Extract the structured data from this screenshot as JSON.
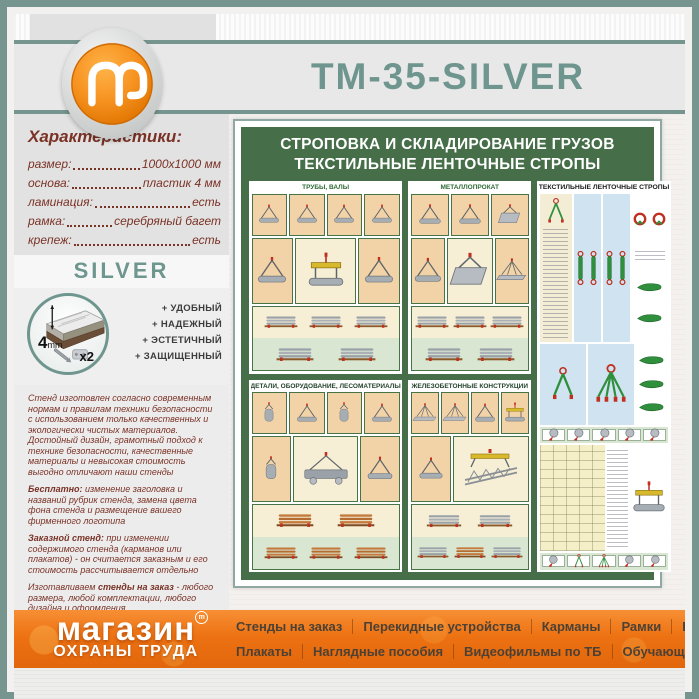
{
  "header": {
    "title": "ТМ-35-SILVER",
    "logo_letter": "m"
  },
  "sidebar": {
    "characteristics": {
      "heading": "Характеристики:",
      "rows": [
        {
          "label": "размер:",
          "value": "1000х1000 мм"
        },
        {
          "label": "основа:",
          "value": "пластик 4 мм"
        },
        {
          "label": "ламинация:",
          "value": "есть"
        },
        {
          "label": "рамка:",
          "value": "серебряный багет"
        },
        {
          "label": "крепеж:",
          "value": "есть"
        }
      ]
    },
    "frame_label": "SILVER",
    "frame_icon": {
      "thickness": "4",
      "unit": "mm",
      "screws": "x2"
    },
    "features": [
      "+ УДОБНЫЙ",
      "+ НАДЕЖНЫЙ",
      "+ ЭСТЕТИЧНЫЙ",
      "+ ЗАЩИЩЕННЫЙ"
    ],
    "paragraphs": [
      [
        {
          "bold": false,
          "text": "Стенд изготовлен согласно современным нормам и правилам техники безопасности с использованием только качественных и экологически чистых материалов. Достойный дизайн, грамотный подход к технике безопасности, качественные материалы и невысокая стоимость выгодно отличают наши стенды"
        }
      ],
      [
        {
          "bold": true,
          "text": "Бесплатно:"
        },
        {
          "bold": false,
          "text": " изменение заголовка и названий рубрик стенда, замена цвета фона стенда и размещение вашего фирменного логотипа"
        }
      ],
      [
        {
          "bold": true,
          "text": "Заказной стенд:"
        },
        {
          "bold": false,
          "text": " при изменении содержимого стенда (карманов или плакатов) - он считается заказным и его стоимость рассчитывается отдельно"
        }
      ],
      [
        {
          "bold": false,
          "text": "Изготавливаем "
        },
        {
          "bold": true,
          "text": "стенды на заказ"
        },
        {
          "bold": false,
          "text": " - любого размера, любой комплектации, любого дизайна и оформления"
        }
      ]
    ]
  },
  "poster": {
    "title_line1": "СТРОПОВКА И СКЛАДИРОВАНИЕ ГРУЗОВ",
    "title_line2": "ТЕКСТИЛЬНЫЕ ЛЕНТОЧНЫЕ СТРОПЫ",
    "panels": [
      "ТРУБЫ, ВАЛЫ",
      "МЕТАЛЛОПРОКАТ",
      "ТЕКСТИЛЬНЫЕ ЛЕНТОЧНЫЕ СТРОПЫ",
      "ДЕТАЛИ, ОБОРУДОВАНИЕ, ЛЕСОМАТЕРИАЛЫ",
      "ЖЕЛЕЗОБЕТОННЫЕ КОНСТРУКЦИИ"
    ]
  },
  "footer": {
    "logo_line1": "магазин",
    "logo_reg": "m",
    "logo_line2": "ОХРАНЫ ТРУДА",
    "menu_row1": [
      "Стенды на заказ",
      "Перекидные устройства",
      "Карманы",
      "Рамки",
      "Багет"
    ],
    "menu_row2": [
      "Плакаты",
      "Наглядные пособия",
      "Видеофильмы по ТБ",
      "Обучающие программы"
    ]
  },
  "colors": {
    "frame_teal": "#76958F",
    "title_teal": "#6E958E",
    "text_maroon": "#7A3226",
    "banner_orange": "#ED7212",
    "poster_green": "#456E49"
  }
}
